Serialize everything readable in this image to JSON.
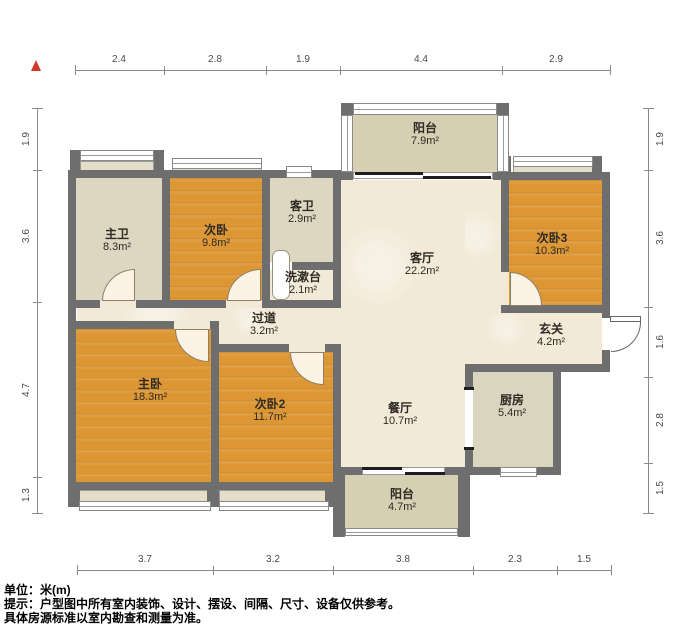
{
  "plan_title": "户型图",
  "rooms": [
    {
      "id": "balcony-top",
      "name": "阳台",
      "area": "7.9m²"
    },
    {
      "id": "master-bath",
      "name": "主卫",
      "area": "8.3m²"
    },
    {
      "id": "bedroom",
      "name": "次卧",
      "area": "9.8m²"
    },
    {
      "id": "guest-bath",
      "name": "客卫",
      "area": "2.9m²"
    },
    {
      "id": "washstand",
      "name": "洗漱台",
      "area": "2.1m²"
    },
    {
      "id": "living-room",
      "name": "客厅",
      "area": "22.2m²"
    },
    {
      "id": "bedroom-3",
      "name": "次卧3",
      "area": "10.3m²"
    },
    {
      "id": "corridor",
      "name": "过道",
      "area": "3.2m²"
    },
    {
      "id": "entry",
      "name": "玄关",
      "area": "4.2m²"
    },
    {
      "id": "master-bedroom",
      "name": "主卧",
      "area": "18.3m²"
    },
    {
      "id": "bedroom-2",
      "name": "次卧2",
      "area": "11.7m²"
    },
    {
      "id": "dining-room",
      "name": "餐厅",
      "area": "10.7m²"
    },
    {
      "id": "kitchen",
      "name": "厨房",
      "area": "5.4m²"
    },
    {
      "id": "balcony-bottom",
      "name": "阳台",
      "area": "4.7m²"
    }
  ],
  "dims": {
    "top": [
      "2.4",
      "2.8",
      "1.9",
      "4.4",
      "2.9"
    ],
    "bottom": [
      "3.7",
      "3.2",
      "3.8",
      "2.3",
      "1.5"
    ],
    "left": [
      "1.9",
      "3.6",
      "4.7",
      "1.3"
    ],
    "right": [
      "1.9",
      "3.6",
      "1.6",
      "2.8",
      "1.5"
    ]
  },
  "footer": {
    "unit": "单位：米(m)",
    "tip": "提示：户型图中所有室内装饰、设计、摆设、间隔、尺寸、设备仅供参考。",
    "note": "具体房源标准以室内勘查和测量为准。"
  },
  "icons": {
    "north_arrow": "north-arrow"
  },
  "colors": {
    "wall": "#6e6e6e",
    "bedroom_fill": "#dc9634",
    "hall_fill": "#f2e9d7",
    "bath_fill": "#ddd7c1",
    "balcony_fill": "#d6cfb4",
    "kitchen_fill": "#dad5bf",
    "north_arrow": "#cf3a28"
  }
}
